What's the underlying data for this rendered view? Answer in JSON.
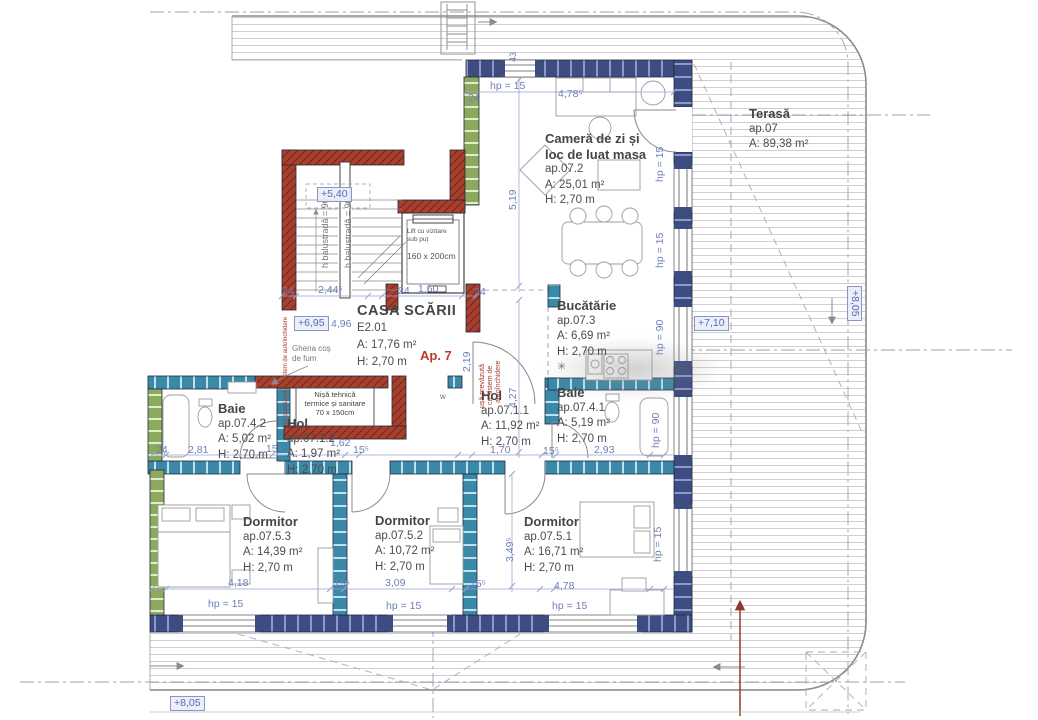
{
  "rooms": {
    "living": {
      "name1": "Cameră de zi și",
      "name2": "loc de luat masa",
      "unit": "ap.07.2",
      "area": "A: 25,01 m²",
      "height": "H: 2,70 m"
    },
    "terasa": {
      "name": "Terasă",
      "unit": "ap.07",
      "area": "A: 89,38 m²"
    },
    "bucatarie": {
      "name": "Bucătărie",
      "unit": "ap.07.3",
      "area": "A: 6,69 m²",
      "height": "H: 2,70 m"
    },
    "casa_scarii": {
      "name": "CASA SCĂRII",
      "unit": "E2.01",
      "area": "A: 17,76 m²",
      "height": "H: 2,70 m"
    },
    "baie_mare": {
      "name": "Baie",
      "unit": "ap.07.4.1",
      "area": "A: 5,19 m²",
      "height": "H: 2,70 m"
    },
    "hol_mare": {
      "name": "Hol",
      "unit": "ap.07.1.1",
      "area": "A: 11,92 m²",
      "height": "H: 2,70 m"
    },
    "baie_mica": {
      "name": "Baie",
      "unit": "ap.07.4.2",
      "area": "A: 5,02 m²",
      "height": "H: 2,70 m"
    },
    "hol_mic": {
      "name": "Hol",
      "unit": "ap.07.1.2",
      "area": "A: 1,97 m²",
      "height": "H: 2,70 m"
    },
    "dormitor1": {
      "name": "Dormitor",
      "unit": "ap.07.5.1",
      "area": "A: 16,71 m²",
      "height": "H: 2,70 m"
    },
    "dormitor2": {
      "name": "Dormitor",
      "unit": "ap.07.5.2",
      "area": "A: 10,72 m²",
      "height": "H: 2,70 m"
    },
    "dormitor3": {
      "name": "Dormitor",
      "unit": "ap.07.5.3",
      "area": "A: 14,39 m²",
      "height": "H: 2,70 m"
    }
  },
  "apartment_label": "Ap. 7",
  "lift": {
    "line1": "Lift cu vizitare",
    "line2": "sub puț",
    "size": "160 x 200cm"
  },
  "nisa": {
    "line1": "Nișă tehnică",
    "line2": "termice și sanitare",
    "size": "70 x 150cm"
  },
  "ghena": {
    "line1": "Ghena coș",
    "line2": "de fum"
  },
  "door_note": {
    "l1": "ușă prevăzută",
    "l2": "cu sistem de",
    "l3": "autoînchidere",
    "full": "ușă prevăzută cu sistem de autoînchidere"
  },
  "balustrade_note": "h balustradă = 90",
  "levels": {
    "stair": "+5,40",
    "landing": "+6,95",
    "terrace": "+7,10",
    "terrace_edge": "+8,05",
    "bottom": "+8,05"
  },
  "dims": {
    "hp15": "hp = 15",
    "hp90": "hp = 90",
    "d24": "24",
    "d43": "43",
    "d478s": "4,78⁵",
    "d478": "4,78",
    "d519": "5,19",
    "d244s": "2,44⁵",
    "d160": "1,60",
    "d496": "4,96",
    "d427": "4,27",
    "d219": "2,19",
    "d170": "1,70",
    "d155": "15⁵",
    "d281": "2,81",
    "d162": "1,62",
    "d293": "2,93",
    "d418": "4,18",
    "d309": "3,09",
    "d349s": "3,49⁵"
  },
  "symbols": {
    "w": "w",
    "star": "✳"
  },
  "colors": {
    "wall_navy": "#3d4c82",
    "wall_teal": "#3b89a8",
    "wall_green": "#8caa5e",
    "wall_red": "#a8402f",
    "dim_blue": "#6e7eb8",
    "note_red": "#a83a2b"
  }
}
